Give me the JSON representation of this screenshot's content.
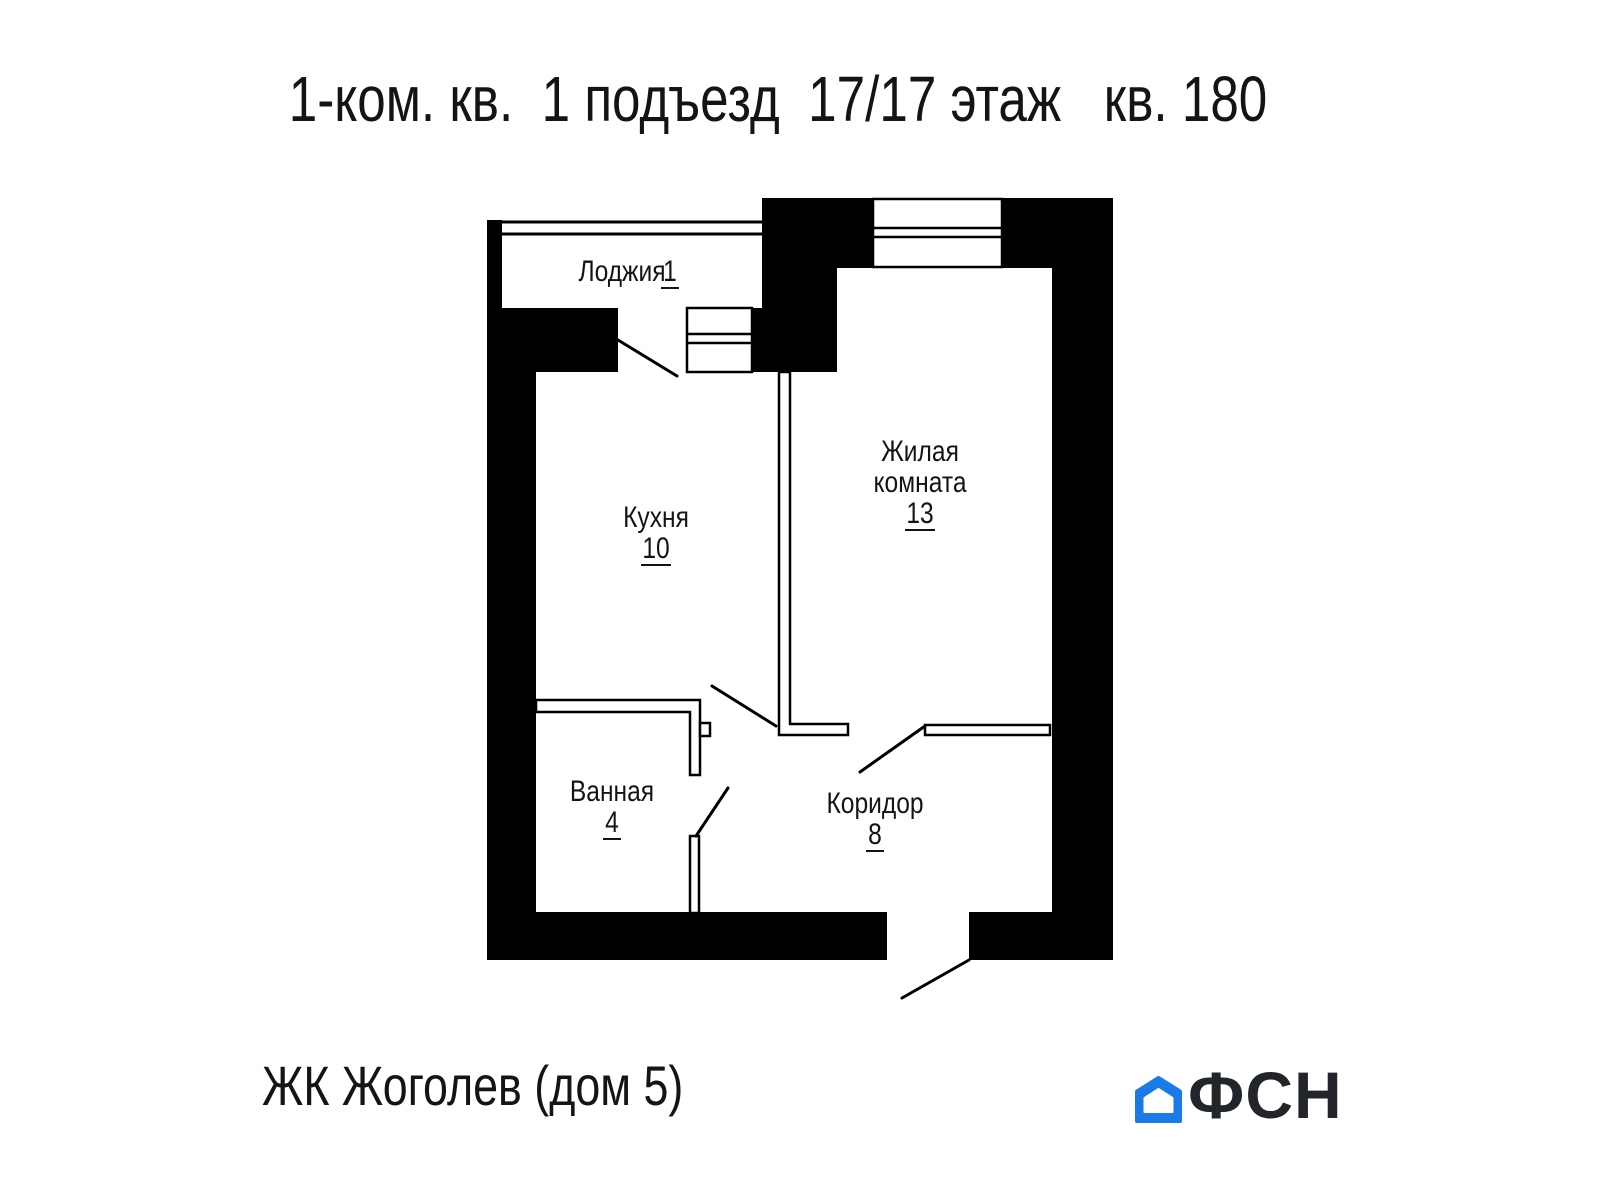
{
  "title": "1-ком. кв.  1 подъезд  17/17 этаж   кв. 180",
  "plan": {
    "rooms": {
      "loggia": {
        "label": "Лоджия",
        "area": "1"
      },
      "kitchen": {
        "label": "Кухня",
        "area": "10"
      },
      "living": {
        "label_line1": "Жилая",
        "label_line2": "комната",
        "area": "13"
      },
      "bathroom": {
        "label": "Ванная",
        "area": "4"
      },
      "corridor": {
        "label": "Коридор",
        "area": "8"
      }
    }
  },
  "footer": {
    "project": "ЖК Жоголев (дом 5)",
    "logo_text": "ФСН"
  },
  "colors": {
    "walls": "#000000",
    "logo_blue": "#1a7ae8",
    "logo_dark": "#22252a"
  }
}
